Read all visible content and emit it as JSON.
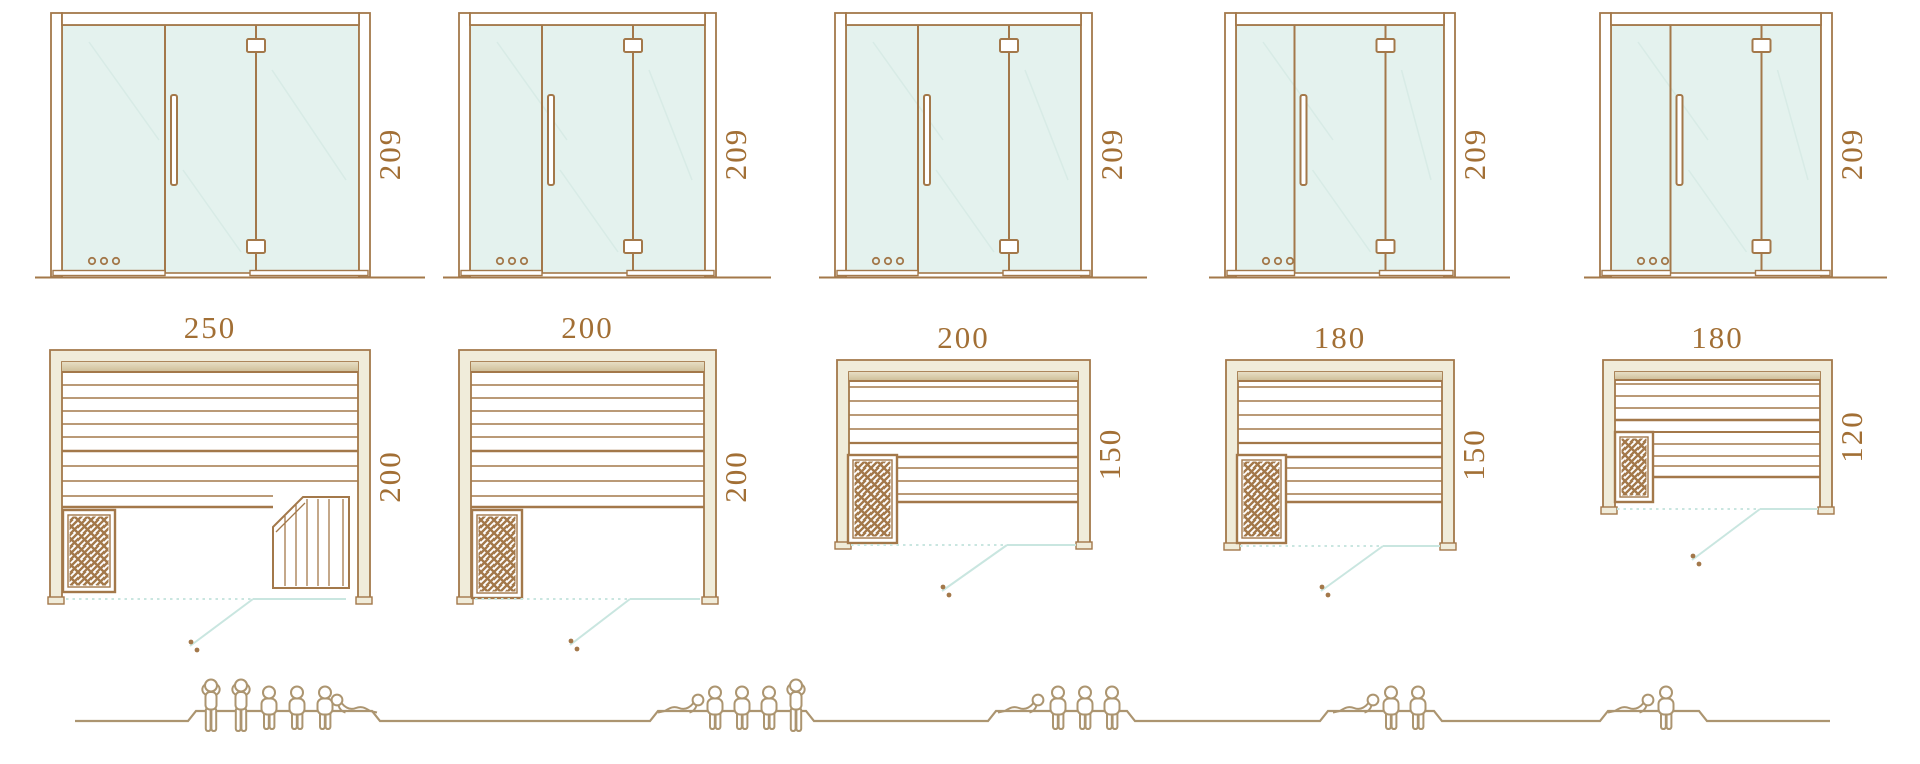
{
  "palette": {
    "line_brown": "#A3784A",
    "dimension_text": "#A26F35",
    "glass_tint": "#E4F2EE",
    "glass_reflection": "#D8EBE6",
    "wall_cream": "#F0ECDA",
    "shade_tan_light": "#E7DEC4",
    "shade_tan_dark": "#CDBD97",
    "door_swing_teal": "#C9E6E0",
    "people_tan": "#AC9570",
    "white": "#FFFFFF"
  },
  "saunas": [
    {
      "door_height": "209",
      "width": "250",
      "depth": "200",
      "capacity_total": 6,
      "capacity": {
        "standing": 2,
        "seated": 3,
        "lying": 1
      }
    },
    {
      "door_height": "209",
      "width": "200",
      "depth": "200",
      "capacity_total": 5,
      "capacity": {
        "standing": 1,
        "seated": 3,
        "lying": 1
      }
    },
    {
      "door_height": "209",
      "width": "200",
      "depth": "150",
      "capacity_total": 4,
      "capacity": {
        "standing": 0,
        "seated": 3,
        "lying": 1
      }
    },
    {
      "door_height": "209",
      "width": "180",
      "depth": "150",
      "capacity_total": 3,
      "capacity": {
        "standing": 0,
        "seated": 2,
        "lying": 1
      }
    },
    {
      "door_height": "209",
      "width": "180",
      "depth": "120",
      "capacity_total": 2,
      "capacity": {
        "standing": 0,
        "seated": 1,
        "lying": 1
      }
    }
  ]
}
